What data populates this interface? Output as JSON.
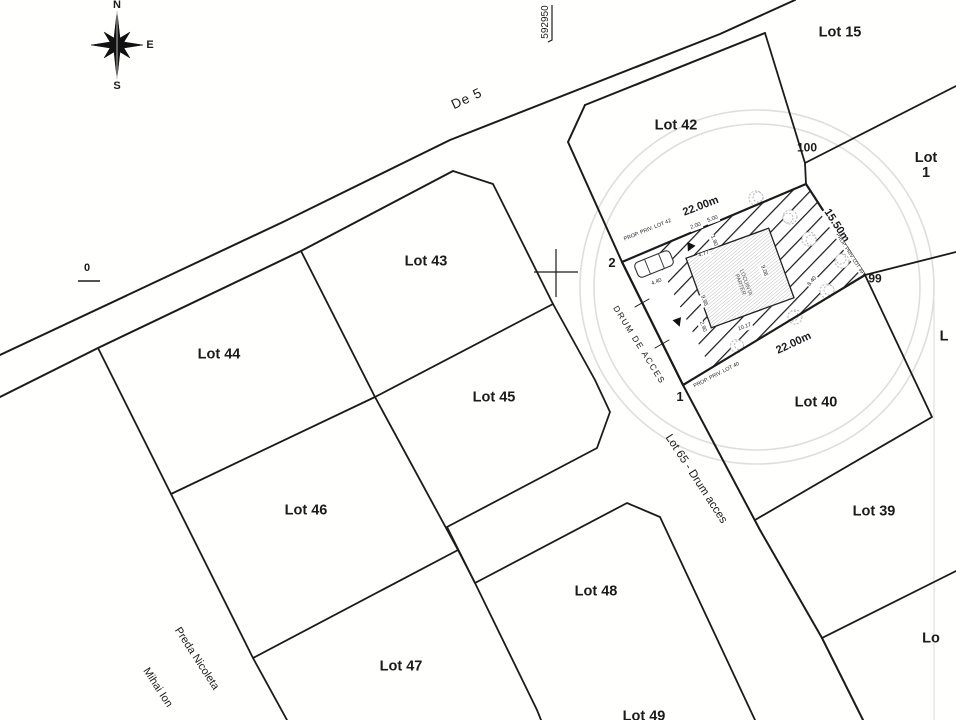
{
  "colors": {
    "line": "#1b1b1b",
    "faint_circle": "#dedede",
    "hatch": "#161616",
    "building_hatch": "#a8a8a8"
  },
  "compass": {
    "north": "N",
    "east": "E",
    "south": "S"
  },
  "labels": [
    {
      "name": "lot-label-15",
      "text": "Lot 15",
      "x": 840,
      "y": 33,
      "size": 14.5,
      "weight": 700
    },
    {
      "name": "lot-label-1",
      "text": "Lot 1",
      "x": 926,
      "y": 166,
      "size": 14.5,
      "weight": 700
    },
    {
      "name": "lot-label-42",
      "text": "Lot 42",
      "x": 676,
      "y": 126,
      "size": 14.5,
      "weight": 700
    },
    {
      "name": "lot-label-43",
      "text": "Lot 43",
      "x": 426,
      "y": 262,
      "size": 14.5,
      "weight": 700
    },
    {
      "name": "lot-label-44",
      "text": "Lot 44",
      "x": 219,
      "y": 355,
      "size": 14.5,
      "weight": 700
    },
    {
      "name": "lot-label-45",
      "text": "Lot 45",
      "x": 494,
      "y": 398,
      "size": 14.5,
      "weight": 700
    },
    {
      "name": "lot-label-46",
      "text": "Lot 46",
      "x": 306,
      "y": 511,
      "size": 14.5,
      "weight": 700
    },
    {
      "name": "lot-label-47",
      "text": "Lot 47",
      "x": 401,
      "y": 667,
      "size": 14.5,
      "weight": 700
    },
    {
      "name": "lot-label-48",
      "text": "Lot 48",
      "x": 596,
      "y": 592,
      "size": 14.5,
      "weight": 700
    },
    {
      "name": "lot-label-49",
      "text": "Lot 49",
      "x": 644,
      "y": 717,
      "size": 14.5,
      "weight": 700
    },
    {
      "name": "lot-label-40",
      "text": "Lot 40",
      "x": 816,
      "y": 403,
      "size": 14.5,
      "weight": 700
    },
    {
      "name": "lot-label-39",
      "text": "Lot 39",
      "x": 874,
      "y": 512,
      "size": 14.5,
      "weight": 700
    },
    {
      "name": "lot-label-edge-l",
      "text": "L",
      "x": 944,
      "y": 337,
      "size": 14.5,
      "weight": 700
    },
    {
      "name": "lot-label-edge-lo",
      "text": "Lo",
      "x": 931,
      "y": 639,
      "size": 14.5,
      "weight": 700
    },
    {
      "name": "road-label-de5",
      "text": "De 5",
      "x": 467,
      "y": 99,
      "rot": -25,
      "size": 13.5,
      "weight": 400,
      "ls": 1
    },
    {
      "name": "road-label-lot65",
      "text": "Lot 65 - Drum acces",
      "x": 696,
      "y": 479,
      "rot": 57,
      "size": 11.5,
      "weight": 400
    },
    {
      "name": "road-label-drum-de-acces",
      "text": "DRUM DE ACCES",
      "x": 639,
      "y": 345,
      "rot": 58,
      "size": 8.5,
      "weight": 400,
      "ls": 1.5
    },
    {
      "name": "owner-label-preda-nicoleta",
      "text": "Preda Nicoleta",
      "x": 196,
      "y": 659,
      "rot": 57,
      "size": 11,
      "weight": 400
    },
    {
      "name": "owner-label-mihai-ion",
      "text": "Mihai Ion",
      "x": 157,
      "y": 688,
      "rot": 57,
      "size": 11,
      "weight": 400
    },
    {
      "name": "vertex-label-2",
      "text": "2",
      "x": 612,
      "y": 263,
      "size": 13,
      "weight": 700
    },
    {
      "name": "vertex-label-1",
      "text": "1",
      "x": 680,
      "y": 397,
      "size": 13,
      "weight": 700
    },
    {
      "name": "vertex-label-99",
      "text": "99",
      "x": 875,
      "y": 279,
      "size": 12,
      "weight": 700
    },
    {
      "name": "vertex-label-100",
      "text": "100",
      "x": 807,
      "y": 148,
      "size": 12,
      "weight": 700
    },
    {
      "name": "grid-coord-top",
      "text": "592950",
      "x": 546,
      "y": 22,
      "rot": -90,
      "size": 10,
      "weight": 400
    },
    {
      "name": "grid-coord-left",
      "text": "0",
      "x": 87,
      "y": 269,
      "size": 11,
      "weight": 600
    },
    {
      "name": "plot-dim-top",
      "text": "22.00m",
      "x": 701,
      "y": 207,
      "rot": -21,
      "size": 11,
      "weight": 700,
      "halo": true
    },
    {
      "name": "plot-dim-bottom",
      "text": "22.00m",
      "x": 794,
      "y": 344,
      "rot": -25,
      "size": 11,
      "weight": 700,
      "halo": true
    },
    {
      "name": "plot-dim-right",
      "text": "15.50m",
      "x": 836,
      "y": 226,
      "rot": 57,
      "size": 11,
      "weight": 700,
      "halo": true
    },
    {
      "name": "neighbor-label-lot42",
      "text": "PROP. PRIV. LOT 42",
      "x": 648,
      "y": 231,
      "rot": -22,
      "size": 5.4,
      "weight": 400,
      "halo": true
    },
    {
      "name": "neighbor-label-lot39",
      "text": "PROP. PRIV. LOT 39",
      "x": 849,
      "y": 254,
      "rot": 57,
      "size": 5.0,
      "weight": 400,
      "halo": true
    },
    {
      "name": "neighbor-label-lot40",
      "text": "PROP. PRIV. LOT 40",
      "x": 717,
      "y": 376,
      "rot": -27,
      "size": 5.4,
      "weight": 400,
      "halo": true
    },
    {
      "name": "building-label",
      "text": "LOCUINTA\nPARTER",
      "x": 742,
      "y": 284,
      "rot": 70,
      "size": 5.5,
      "weight": 400,
      "color": "#555555"
    },
    {
      "name": "dim-5-00",
      "text": "5.00",
      "x": 713,
      "y": 220,
      "rot": -20,
      "size": 5.5,
      "halo": true
    },
    {
      "name": "dim-2-00",
      "text": "2.00",
      "x": 696,
      "y": 227,
      "rot": -20,
      "size": 5.5,
      "halo": true
    },
    {
      "name": "dim-1-90",
      "text": "1.90",
      "x": 713,
      "y": 241,
      "rot": 70,
      "size": 5.5,
      "halo": true
    },
    {
      "name": "dim-4-77",
      "text": "4.77",
      "x": 704,
      "y": 255,
      "rot": -20,
      "size": 5.5,
      "halo": true
    },
    {
      "name": "dim-9-06",
      "text": "9.06",
      "x": 763,
      "y": 271,
      "rot": 70,
      "size": 5.5,
      "halo": true
    },
    {
      "name": "dim-9-95",
      "text": "9.95",
      "x": 703,
      "y": 301,
      "rot": 70,
      "size": 5.5,
      "halo": true
    },
    {
      "name": "dim-2-90",
      "text": "2.90",
      "x": 702,
      "y": 327,
      "rot": 70,
      "size": 5.5,
      "halo": true
    },
    {
      "name": "dim-10-17",
      "text": "10.17",
      "x": 745,
      "y": 328,
      "rot": -20,
      "size": 5.5,
      "halo": true
    },
    {
      "name": "dim-4-40",
      "text": "4.40",
      "x": 657,
      "y": 283,
      "rot": -22,
      "size": 5.5,
      "halo": true
    },
    {
      "name": "dim-8-40",
      "text": "8.40",
      "x": 813,
      "y": 282,
      "rot": -50,
      "size": 5.5,
      "halo": true
    }
  ]
}
